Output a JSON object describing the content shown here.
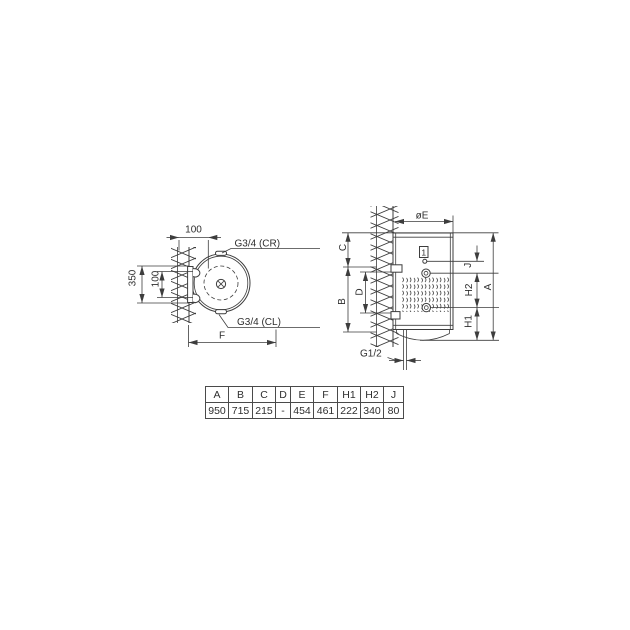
{
  "drawing": {
    "left_view": {
      "dim_top_offset": "100",
      "dim_wall_span": "350",
      "dim_hole_spacing": "100",
      "conn_top": "G3/4 (CR)",
      "conn_bottom": "G3/4 (CL)",
      "dim_depth": "F"
    },
    "right_view": {
      "dim_diameter": "øE",
      "dim_c": "C",
      "dim_d": "D",
      "dim_b": "B",
      "dim_j": "J",
      "dim_h2": "H2",
      "dim_h1": "H1",
      "dim_a": "A",
      "callout_1": "1",
      "conn_drain": "G1/2"
    }
  },
  "table": {
    "headers": [
      "A",
      "B",
      "C",
      "D",
      "E",
      "F",
      "H1",
      "H2",
      "J"
    ],
    "values": [
      "950",
      "715",
      "215",
      "-",
      "454",
      "461",
      "222",
      "340",
      "80"
    ]
  },
  "colors": {
    "line": "#3d3d3d",
    "text": "#2e2e2e",
    "background": "#ffffff"
  }
}
